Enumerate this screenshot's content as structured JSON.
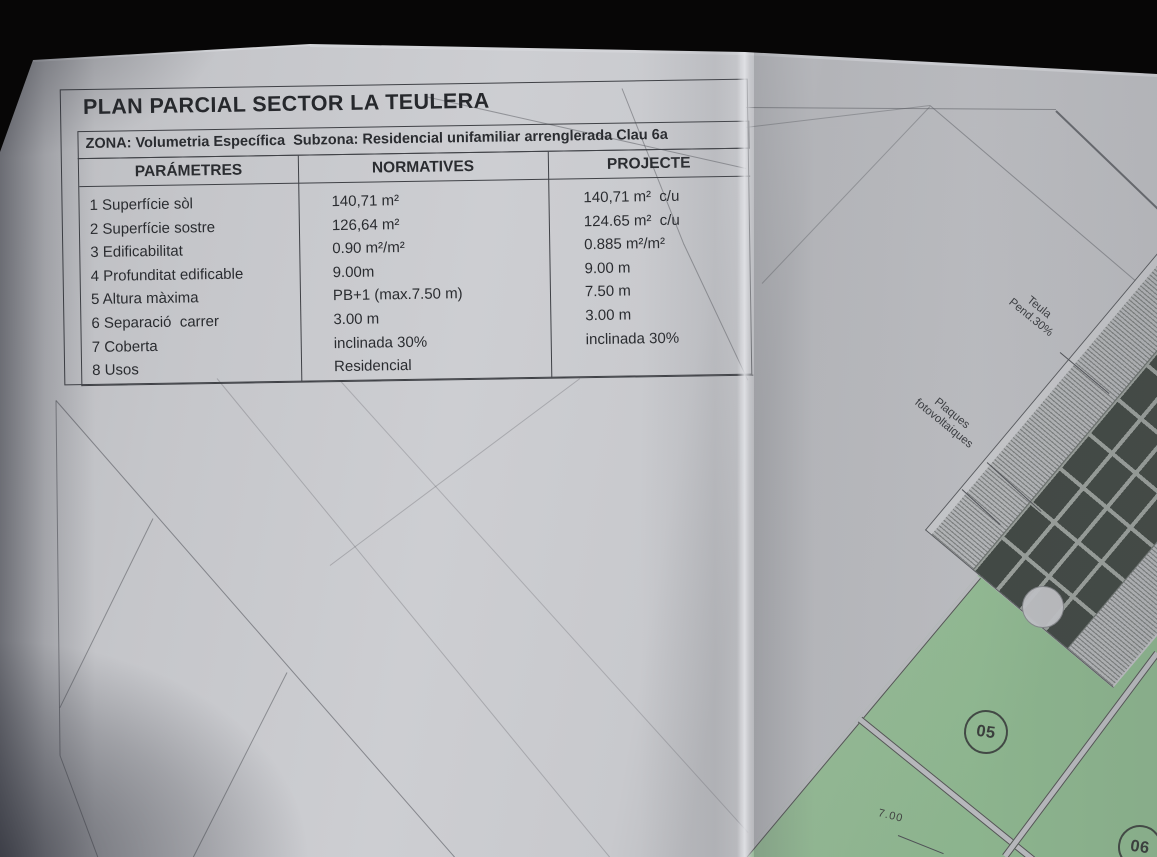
{
  "document": {
    "title": "PLAN PARCIAL SECTOR LA TEULERA",
    "zone_line": "ZONA: Volumetria Específica  Subzona: Residencial unifamiliar arrenglerada Clau 6a",
    "table": {
      "headers": [
        "PARÁMETRES",
        "NORMATIVES",
        "PROJECTE"
      ],
      "rows": [
        {
          "param": "1 Superfície sòl",
          "normatives": "140,71 m²",
          "projecte": "140,71 m²  c/u"
        },
        {
          "param": "2 Superfície sostre",
          "normatives": "126,64 m²",
          "projecte": "124.65 m²  c/u"
        },
        {
          "param": "3 Edificabilitat",
          "normatives": "0.90 m²/m²",
          "projecte": "0.885 m²/m²"
        },
        {
          "param": "4 Profunditat edificable",
          "normatives": "9.00m",
          "projecte": "9.00 m"
        },
        {
          "param": "5 Altura màxima",
          "normatives": "PB+1 (max.7.50 m)",
          "projecte": "7.50 m"
        },
        {
          "param": "6 Separació  carrer",
          "normatives": "3.00 m",
          "projecte": "3.00 m"
        },
        {
          "param": "7 Coberta",
          "normatives": "inclinada 30%",
          "projecte": "inclinada 30%"
        },
        {
          "param": "8 Usos",
          "normatives": "Residencial",
          "projecte": ""
        }
      ]
    }
  },
  "plan": {
    "roof_label": {
      "line1": "Teula",
      "line2": "Pend.30%"
    },
    "panel_label": {
      "line1": "Plaques",
      "line2": "fotovoltaiques"
    },
    "parcels": [
      {
        "id": "05"
      },
      {
        "id": "06"
      }
    ],
    "dimension": "7.00"
  },
  "colors": {
    "paper": "#c6c7cb",
    "parcel_green": "#95bd95",
    "solar_panel": "#3d443f",
    "table_line": "#3f4146",
    "background": "#070606"
  }
}
